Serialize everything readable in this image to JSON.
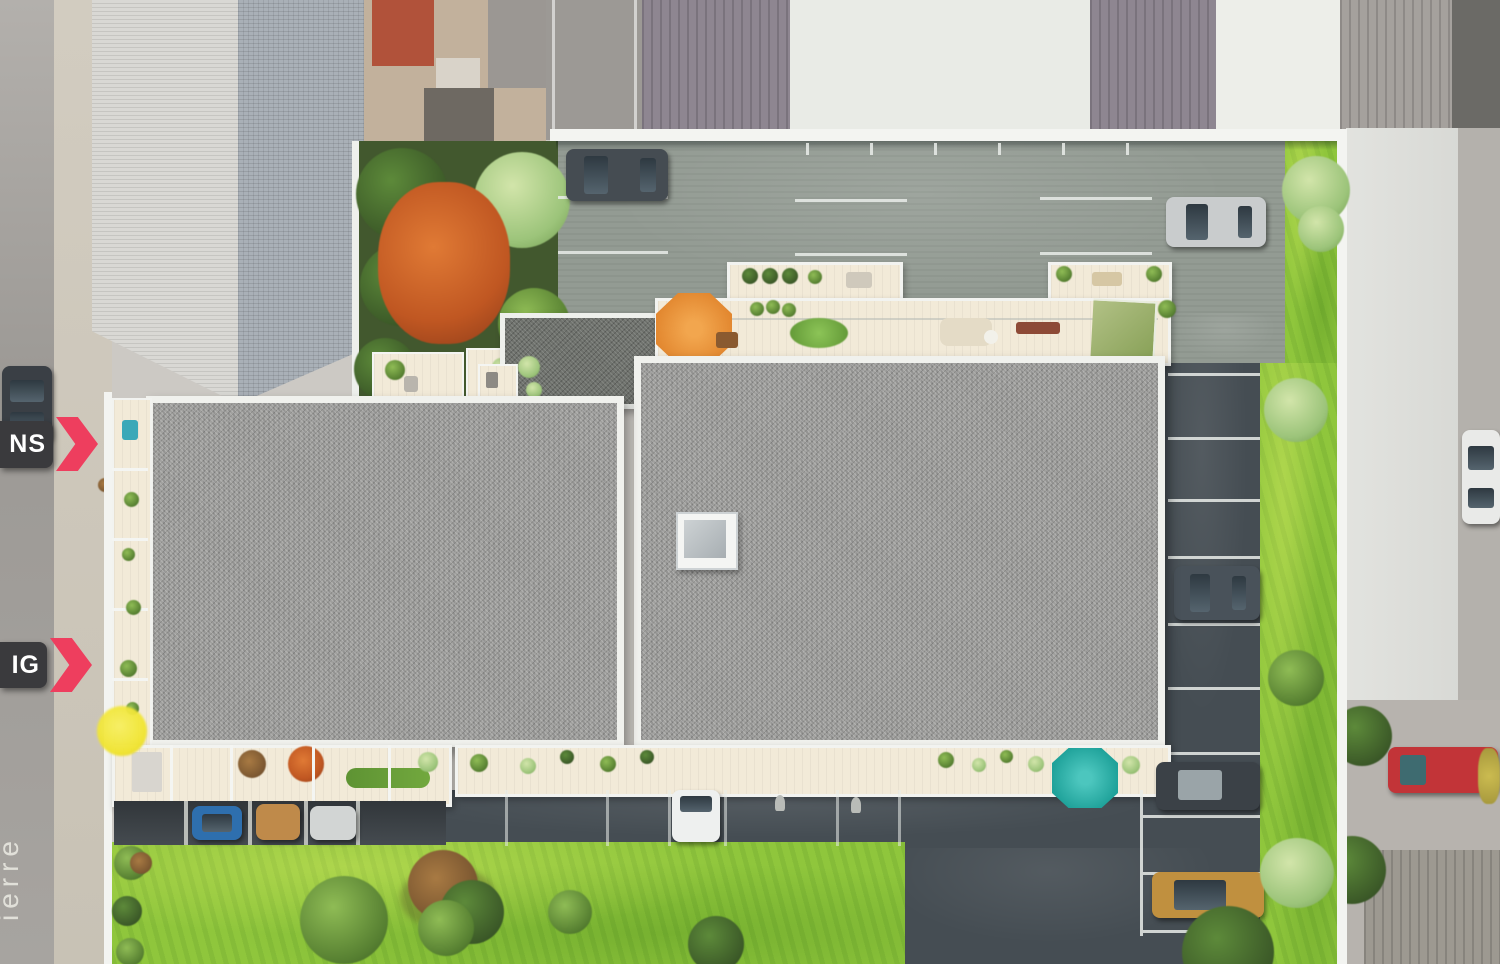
{
  "meta": {
    "view": "aerial 3D site plan of a residential development composited over aerial photography",
    "width_px": 1500,
    "height_px": 964
  },
  "labels": {
    "tag_top": {
      "text": "NS"
    },
    "tag_bottom": {
      "text": "IG"
    },
    "street_fragment": {
      "text": "ierre"
    }
  },
  "markers": {
    "arrow_color": "#ee3e5e",
    "tag_background": "#3a3a3d",
    "tag_text_color": "#ffffff",
    "yellow_dot_color": "#f0e42e"
  },
  "palette": {
    "grass": "#8fc63c",
    "gravel_roof": "#a0a09e",
    "gravel_roof_dark": "#6f726d",
    "terrace_floor": "#f2ead8",
    "asphalt_light": "#939b93",
    "asphalt_dark": "#454d53",
    "parapet_white": "#f0f1ed",
    "parasol_orange": "#e2872f",
    "parasol_teal": "#1fa29a",
    "parasol_green": "#87a056",
    "autumn_tree": "#c05722",
    "neighbor_roof_blue": "#a9b0b7",
    "neighbor_roof_purple": "#8e8691",
    "neighbor_roof_white": "#e9ebe6"
  },
  "scene": {
    "buildings": [
      {
        "name": "west-building",
        "roof": "flat gray gravel roof, balconies west and south"
      },
      {
        "name": "east-building",
        "roof": "flat gray gravel roof with square skylight and roof terraces north and south"
      }
    ],
    "parasols": [
      {
        "color": "orange",
        "location": "north roof terrace west end"
      },
      {
        "color": "green",
        "location": "north roof terrace east end"
      },
      {
        "color": "teal",
        "location": "south terrace east end"
      }
    ],
    "cars": [
      {
        "color": "dark-gray",
        "location": "north parking lot west"
      },
      {
        "color": "silver",
        "location": "north parking lot east"
      },
      {
        "color": "dark-gray",
        "location": "east parking column"
      },
      {
        "color": "white",
        "location": "south courtyard bay"
      },
      {
        "color": "blue",
        "location": "west carport"
      },
      {
        "color": "tan",
        "location": "west carport"
      },
      {
        "color": "white",
        "location": "west carport"
      },
      {
        "color": "dark-suv",
        "location": "south-east parking"
      },
      {
        "color": "gold",
        "location": "south-east parking"
      },
      {
        "color": "dark",
        "location": "west street parked"
      },
      {
        "color": "white",
        "location": "east street parked"
      },
      {
        "color": "red",
        "location": "neighbor driveway south-east"
      }
    ]
  }
}
